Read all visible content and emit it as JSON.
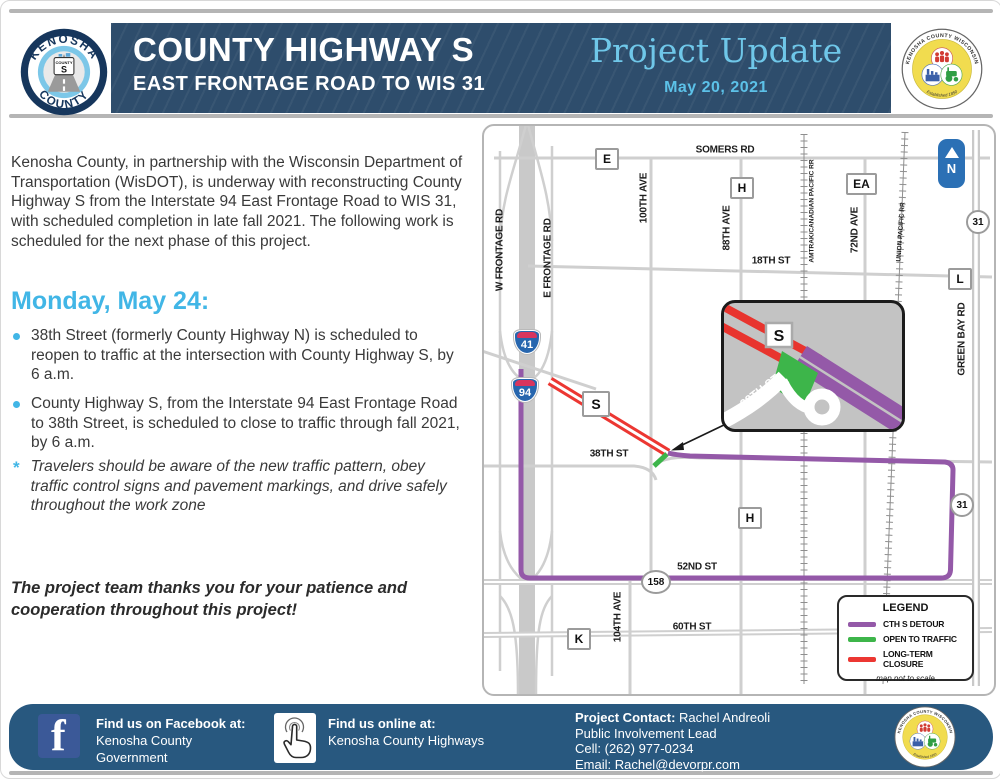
{
  "colors": {
    "header_blue": "#2E4D6C",
    "accent_light_blue": "#41B6E6",
    "project_update_blue": "#6FC7E9",
    "footer_blue": "#28587F",
    "facebook_blue": "#3B5998",
    "detour_purple": "#9459A8",
    "open_green": "#3DB54A",
    "closure_red": "#EC3732",
    "north_arrow_blue": "#2B70B5"
  },
  "header": {
    "title_line1": "COUNTY HIGHWAY S",
    "title_line2": "EAST FRONTAGE ROAD TO WIS 31",
    "project_update": "Project Update",
    "date": "May 20, 2021",
    "logo": {
      "arc_top": "KENOSHA",
      "arc_bottom": "COUNTY",
      "sign_top": "COUNTY",
      "sign_letter": "S"
    },
    "seal": {
      "arc_top": "KENOSHA COUNTY WISCONSIN",
      "arc_bottom": "Established 1850"
    }
  },
  "body": {
    "intro": "Kenosha County, in partnership with the Wisconsin Department of Transportation (WisDOT), is underway with reconstructing County Highway S from the Interstate 94 East Frontage Road to WIS 31, with scheduled completion in late fall 2021. The following work is scheduled for the next phase of this project.",
    "heading": "Monday, May 24:",
    "bullets": [
      "38th Street (formerly County Highway N) is scheduled to reopen to traffic at the intersection with County Highway S, by 6 a.m.",
      "County Highway S, from the Interstate 94 East Frontage Road to 38th Street, is scheduled to close to traffic through fall 2021, by 6 a.m."
    ],
    "note_marker": "*",
    "note": "Travelers should be aware of the new traffic pattern, obey traffic control signs and pavement markings, and drive safely throughout the work zone",
    "closing": "The project team thanks you for your patience and cooperation throughout this project!"
  },
  "map": {
    "labels": {
      "somers": "SOMERS RD",
      "st18": "18TH ST",
      "st38": "38TH ST",
      "st52": "52ND ST",
      "st60": "60TH ST",
      "w_frontage": "W FRONTAGE RD",
      "e_frontage": "E FRONTAGE RD",
      "ave100": "100TH AVE",
      "ave88": "88TH AVE",
      "ave72": "72ND AVE",
      "ave104": "104TH AVE",
      "green_bay": "GREEN BAY RD",
      "amtrak": "AMTRAK/CANADIAN PACIFIC RR",
      "union": "UNION PACIFIC RR"
    },
    "markers": {
      "e": "E",
      "h_north": "H",
      "ea": "EA",
      "l": "L",
      "wis31_top": "31",
      "s": "S",
      "h_south": "H",
      "wis31_bottom": "31",
      "wis158": "158",
      "k": "K",
      "i41": "41",
      "i94": "94"
    },
    "north": "N",
    "inset": {
      "street": "38TH ST",
      "marker": "S"
    },
    "legend": {
      "title": "LEGEND",
      "items": [
        {
          "label": "CTH S DETOUR",
          "color": "#9459A8"
        },
        {
          "label": "OPEN TO TRAFFIC",
          "color": "#3DB54A"
        },
        {
          "label": "LONG-TERM CLOSURE",
          "color": "#EC3732"
        }
      ],
      "note": "map not to scale"
    }
  },
  "footer": {
    "facebook": {
      "icon_letter": "f",
      "heading": "Find us on Facebook at:",
      "line1": "Kenosha County",
      "line2": "Government"
    },
    "online": {
      "heading": "Find us online at:",
      "line1": "Kenosha County Highways"
    },
    "contact": {
      "label": "Project Contact:",
      "name": "Rachel Andreoli",
      "role": "Public Involvement Lead",
      "cell": "Cell: (262) 977-0234",
      "email": "Email: Rachel@devorpr.com"
    }
  }
}
